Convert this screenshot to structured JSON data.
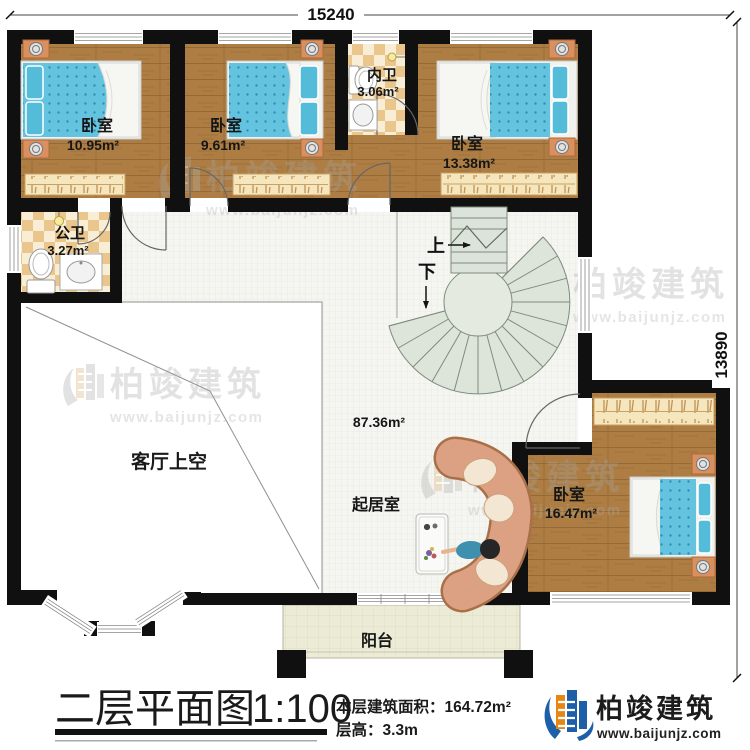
{
  "dimensions": {
    "top": "15240",
    "right": "13890"
  },
  "rooms": {
    "bedroom1": {
      "label": "卧室",
      "area": "10.95m²"
    },
    "bedroom2": {
      "label": "卧室",
      "area": "9.61m²"
    },
    "bedroom3": {
      "label": "卧室",
      "area": "13.38m²"
    },
    "bedroom4": {
      "label": "卧室",
      "area": "16.47m²"
    },
    "inner_bath": {
      "label": "内卫",
      "area": "3.06m²"
    },
    "public_bath": {
      "label": "公卫",
      "area": "3.27m²"
    },
    "living": {
      "label": "起居室",
      "area": "87.36m²"
    },
    "void": {
      "label": "客厅上空"
    },
    "balcony": {
      "label": "阳台"
    }
  },
  "stairs": {
    "up": "上",
    "down": "下"
  },
  "caption": {
    "title": "二层平面图",
    "scale": "1:100",
    "area_label": "本层建筑面积：",
    "area_value": "164.72m²",
    "height_label": "层高：",
    "height_value": "3.3m"
  },
  "brand": {
    "name": "柏竣建筑",
    "site": "www.baijunjz.com"
  },
  "watermark": {
    "name": "柏竣建筑",
    "site": "www.baijunjz.com"
  },
  "colors": {
    "wall": "#101010",
    "wood": "#ad7d44",
    "mattress": "#64c4df",
    "brand_blue": "#1d5fa8",
    "brand_orange": "#e88613"
  }
}
